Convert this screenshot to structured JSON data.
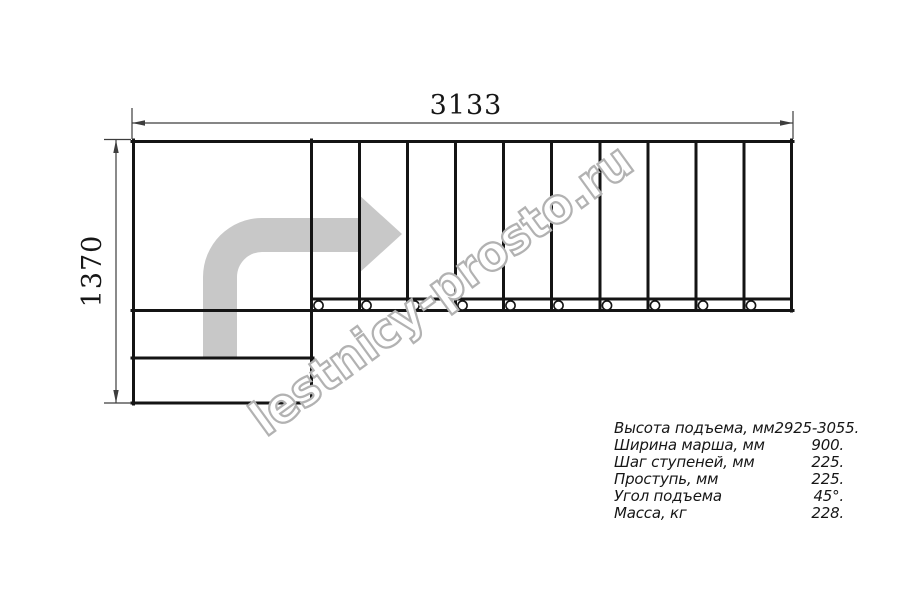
{
  "drawing": {
    "title": "L-shaped staircase plan view",
    "width_dimension": "3133",
    "height_dimension": "1370",
    "steps_in_straight_flight": 10,
    "lower_steps": 2,
    "colors": {
      "line": "#141414",
      "dimension_line": "#3d3d3d",
      "arrow_fill": "#c8c8c8",
      "watermark_outline": "#b2b2b2",
      "background": "#ffffff"
    }
  },
  "watermark": {
    "text": "lestnicy-prosto.ru"
  },
  "specs": {
    "rows": [
      {
        "label": "Высота подъема, мм",
        "value": "2925-3055."
      },
      {
        "label": "Ширина марша, мм",
        "value": "900."
      },
      {
        "label": "Шаг ступеней, мм",
        "value": "225."
      },
      {
        "label": "Проступь, мм",
        "value": "225."
      },
      {
        "label": "Угол подъема",
        "value": "45°."
      },
      {
        "label": "Масса, кг",
        "value": "228."
      }
    ]
  }
}
